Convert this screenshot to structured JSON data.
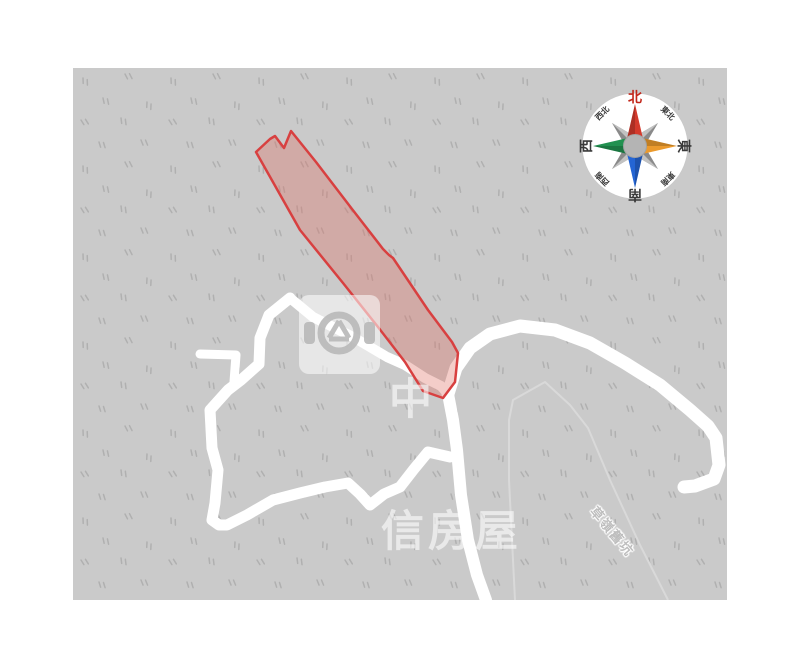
{
  "page": {
    "background": "#ffffff"
  },
  "map": {
    "background": "#cacaca",
    "texture_color": "#b0b0b0",
    "road_color": "#ffffff",
    "boundary_color": "#d9d9d9",
    "road_label": "草嶺舊坑",
    "parcel": {
      "stroke": "#d84040",
      "fill": "rgba(224,109,97,0.34)"
    }
  },
  "watermark": {
    "brand": "中信房屋",
    "line1": "中",
    "line2": "信房屋"
  },
  "compass": {
    "north": "北",
    "south": "南",
    "east": "東",
    "west": "西",
    "northeast": "東北",
    "northwest": "西北",
    "southeast": "東南",
    "southwest": "西南",
    "colors": {
      "north": "#d43a2c",
      "east": "#eb9a2d",
      "south": "#2465d4",
      "west": "#219150",
      "minor_dark": "#8a8a8a",
      "minor_light": "#c2c2c2",
      "hub": "#b4b4b4",
      "north_label": "#c2271b"
    }
  }
}
